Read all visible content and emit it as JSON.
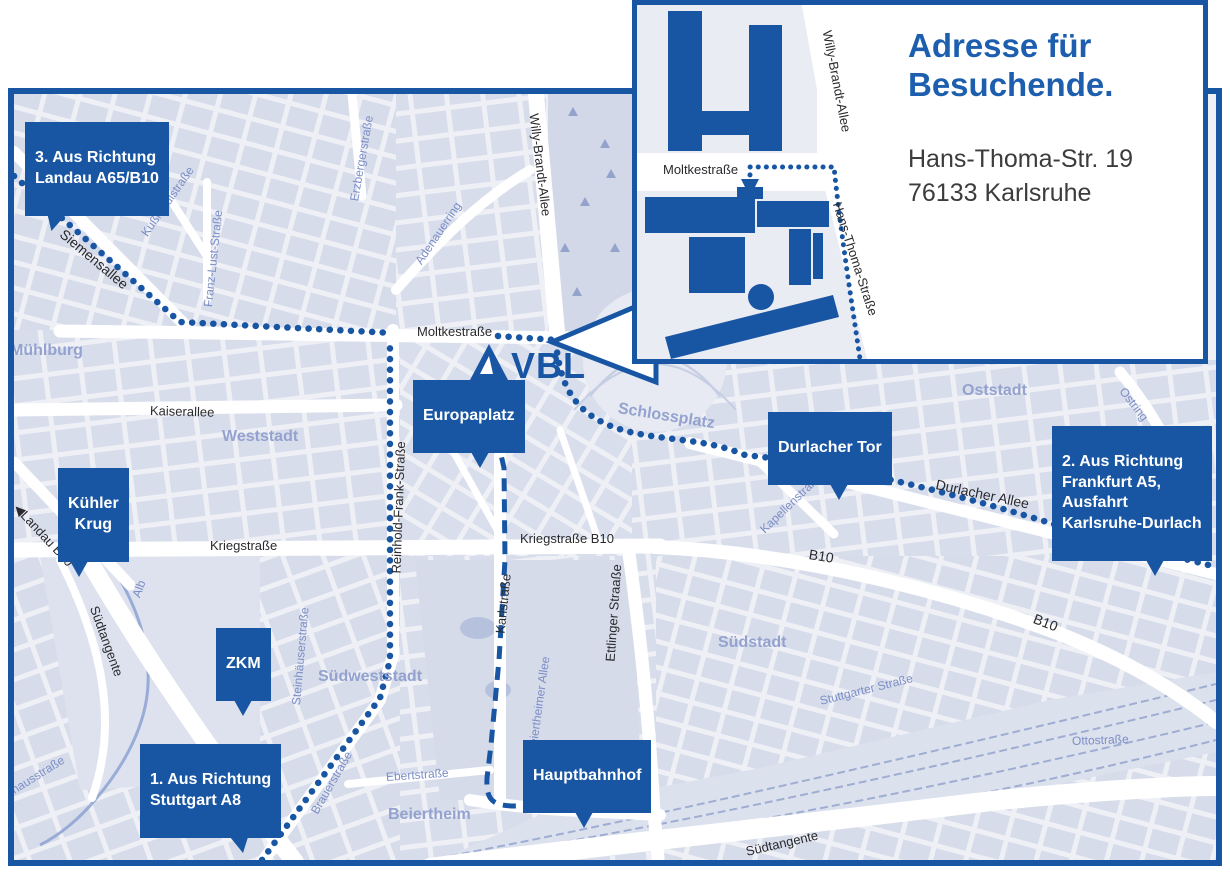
{
  "colors": {
    "accent_blue": "#1856a4",
    "heading_blue": "#1d5fae",
    "route_blue": "#1c55a3",
    "map_block": "#d8ddeb",
    "map_background": "#eef0f6",
    "district_text": "#94a2cf",
    "minor_street_text": "#7b8ec6"
  },
  "inset": {
    "heading": "Adresse für\nBesuchende.",
    "address_line1": "Hans-Thoma-Str. 19",
    "address_line2": "76133 Karlsruhe",
    "streets": {
      "moltkestrasse": "Moltkestraße",
      "willy_brandt_allee": "Willy-Brandt-Allee",
      "hans_thoma_strasse": "Hans-Thoma-Straße"
    }
  },
  "logo": {
    "text": "VBL"
  },
  "markers": {
    "landau": {
      "label": "3. Aus Richtung\nLandau A65/B10"
    },
    "kuehler_krug": {
      "label": "Kühler\nKrug"
    },
    "zkm": {
      "label": "ZKM"
    },
    "stuttgart": {
      "label": "1. Aus Richtung\nStuttgart A8"
    },
    "europaplatz": {
      "label": "Europaplatz"
    },
    "durlacher_tor": {
      "label": "Durlacher Tor"
    },
    "frankfurt": {
      "label": "2. Aus Richtung\nFrankfurt A5,\nAusfahrt\nKarlsruhe-Durlach"
    },
    "hauptbahnhof": {
      "label": "Hauptbahnhof"
    }
  },
  "districts": {
    "muehlburg": "Mühlburg",
    "weststadt": "Weststadt",
    "oststadt": "Oststadt",
    "suedstadt": "Südstadt",
    "suedweststadt": "Südweststadt",
    "beiertheim": "Beiertheim",
    "schlossplatz": "Schlossplatz"
  },
  "streets": {
    "moltkestrasse": "Moltkestraße",
    "kaiserallee": "Kaiserallee",
    "kriegstrasse": "Kriegstraße",
    "kriegstrasse_b10": "Kriegstraße B10",
    "b10": "B10",
    "durlacher_allee": "Durlacher Allee",
    "siemensallee": "Siemensallee",
    "kussmaulstrasse": "Kußmaulstraße",
    "franz_lust_strasse": "Franz-Lust-Straße",
    "erzbergerstrasse": "Erzbergerstraße",
    "willy_brandt_allee": "Willy-Brandt-Allee",
    "adenauerring": "Adenauerring",
    "reinhold_frank_strasse": "Reinhold-Frank-Straße",
    "karlstrasse": "Karlstraße",
    "ettlinger_strasse": "Ettlinger Straaße",
    "kapellenstrasse": "Kapellenstraße",
    "ostring": "Ostring",
    "steinhaeuserstrasse": "Steinhäuserstraße",
    "stuttgarter_strasse": "Stuttgarter Straße",
    "beiertheimer_allee": "Beiertheimer Allee",
    "brauerstrasse": "Brauerstraße",
    "ebertstrasse": "Ebertstraße",
    "suedtangente": "Südtangente",
    "landau_b10": "Landau B10",
    "landau_arrow": "◀",
    "alb": "Alb",
    "ottostrasse": "Ottostraße",
    "pulverhausstrasse": "lverhausstraße"
  }
}
